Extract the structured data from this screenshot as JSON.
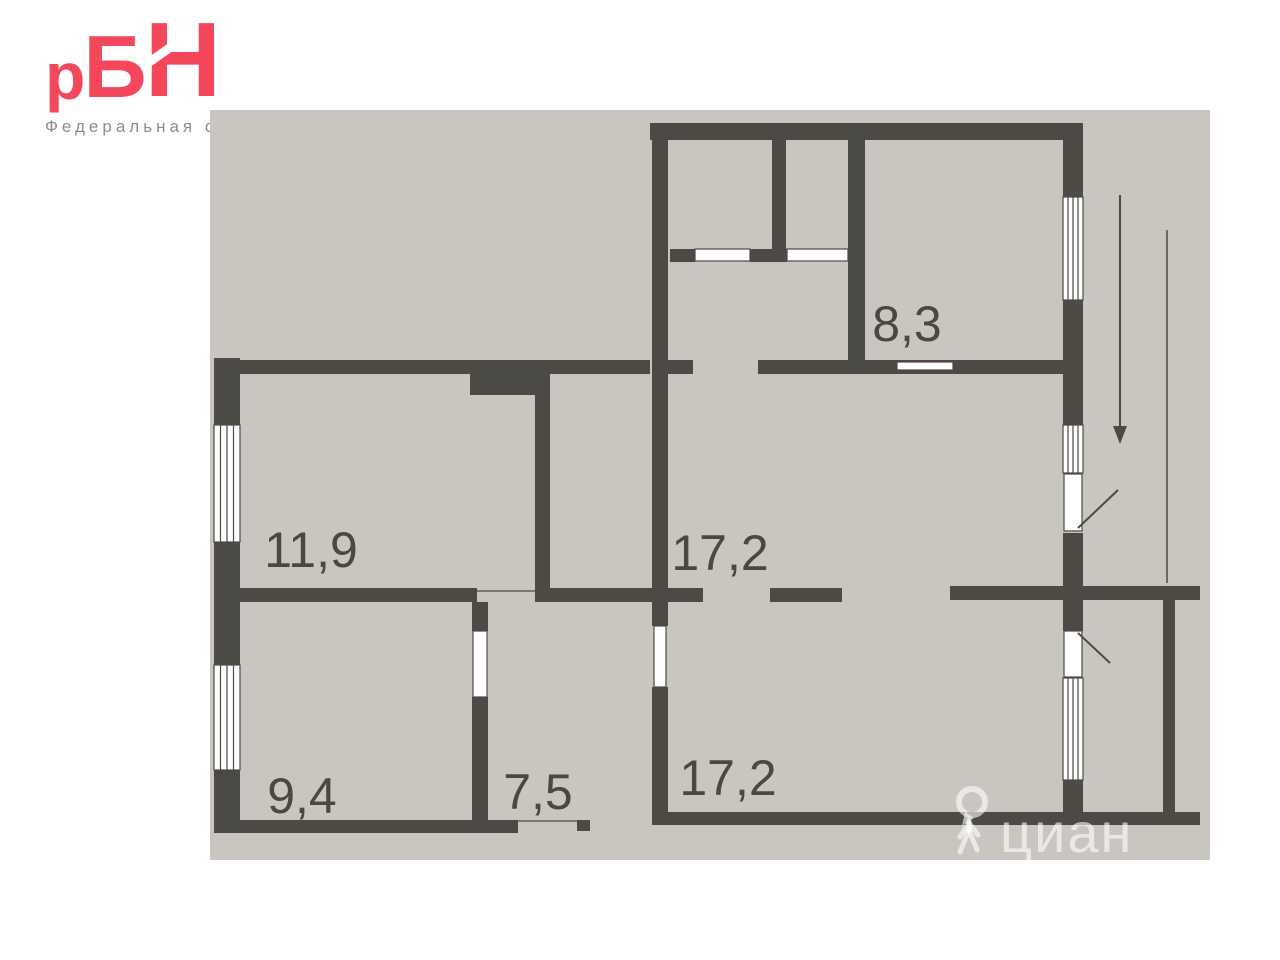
{
  "brand": {
    "logo": {
      "r": "р",
      "b": "Б",
      "n": "Н"
    },
    "tagline": "Федеральная сеть"
  },
  "colors": {
    "page_background": "#ffffff",
    "plan_background": "#c9c6bf",
    "wall": "#4c4a45",
    "logo": "#f4475c",
    "tagline": "#8d8d8d",
    "room_label": "#4a4843",
    "watermark": "rgba(255,255,255,0.6)"
  },
  "floor_plan": {
    "rooms": [
      {
        "id": "room-top-right",
        "area": "8,3"
      },
      {
        "id": "room-upper-left",
        "area": "11,9"
      },
      {
        "id": "room-center",
        "area": "17,2"
      },
      {
        "id": "room-bottom-center",
        "area": "17,2"
      },
      {
        "id": "room-bottom-left",
        "area": "9,4"
      },
      {
        "id": "room-bottom-middle",
        "area": "7,5"
      }
    ]
  },
  "watermark": {
    "text": "циан"
  }
}
